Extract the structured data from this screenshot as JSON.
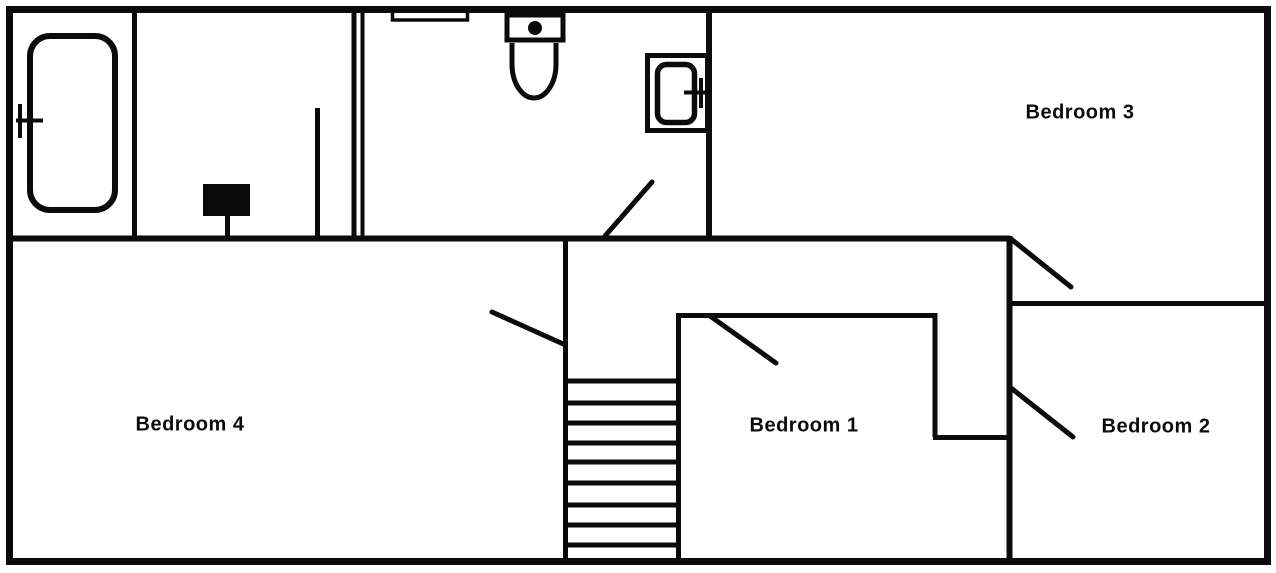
{
  "plan": {
    "kind": "floor-plan",
    "colors": {
      "line": "#0b0b0b",
      "background": "#ffffff"
    }
  },
  "rooms": [
    {
      "id": "bedroom-1",
      "label": "Bedroom 1"
    },
    {
      "id": "bedroom-2",
      "label": "Bedroom 2"
    },
    {
      "id": "bedroom-3",
      "label": "Bedroom 3"
    },
    {
      "id": "bedroom-4",
      "label": "Bedroom 4"
    }
  ],
  "fixtures": [
    "bathtub-icon",
    "bathtub-faucet-icon",
    "vanity-counter-icon",
    "toilet-icon",
    "wall-sink-icon",
    "sink-faucet-icon",
    "chimney-box-icon",
    "staircase-icon",
    "door-swing-bathroom-icon",
    "door-swing-bedroom-1-icon",
    "door-swing-bedroom-2-icon",
    "door-swing-bedroom-3-icon",
    "door-swing-bedroom-4-icon",
    "door-leaf-icon"
  ]
}
